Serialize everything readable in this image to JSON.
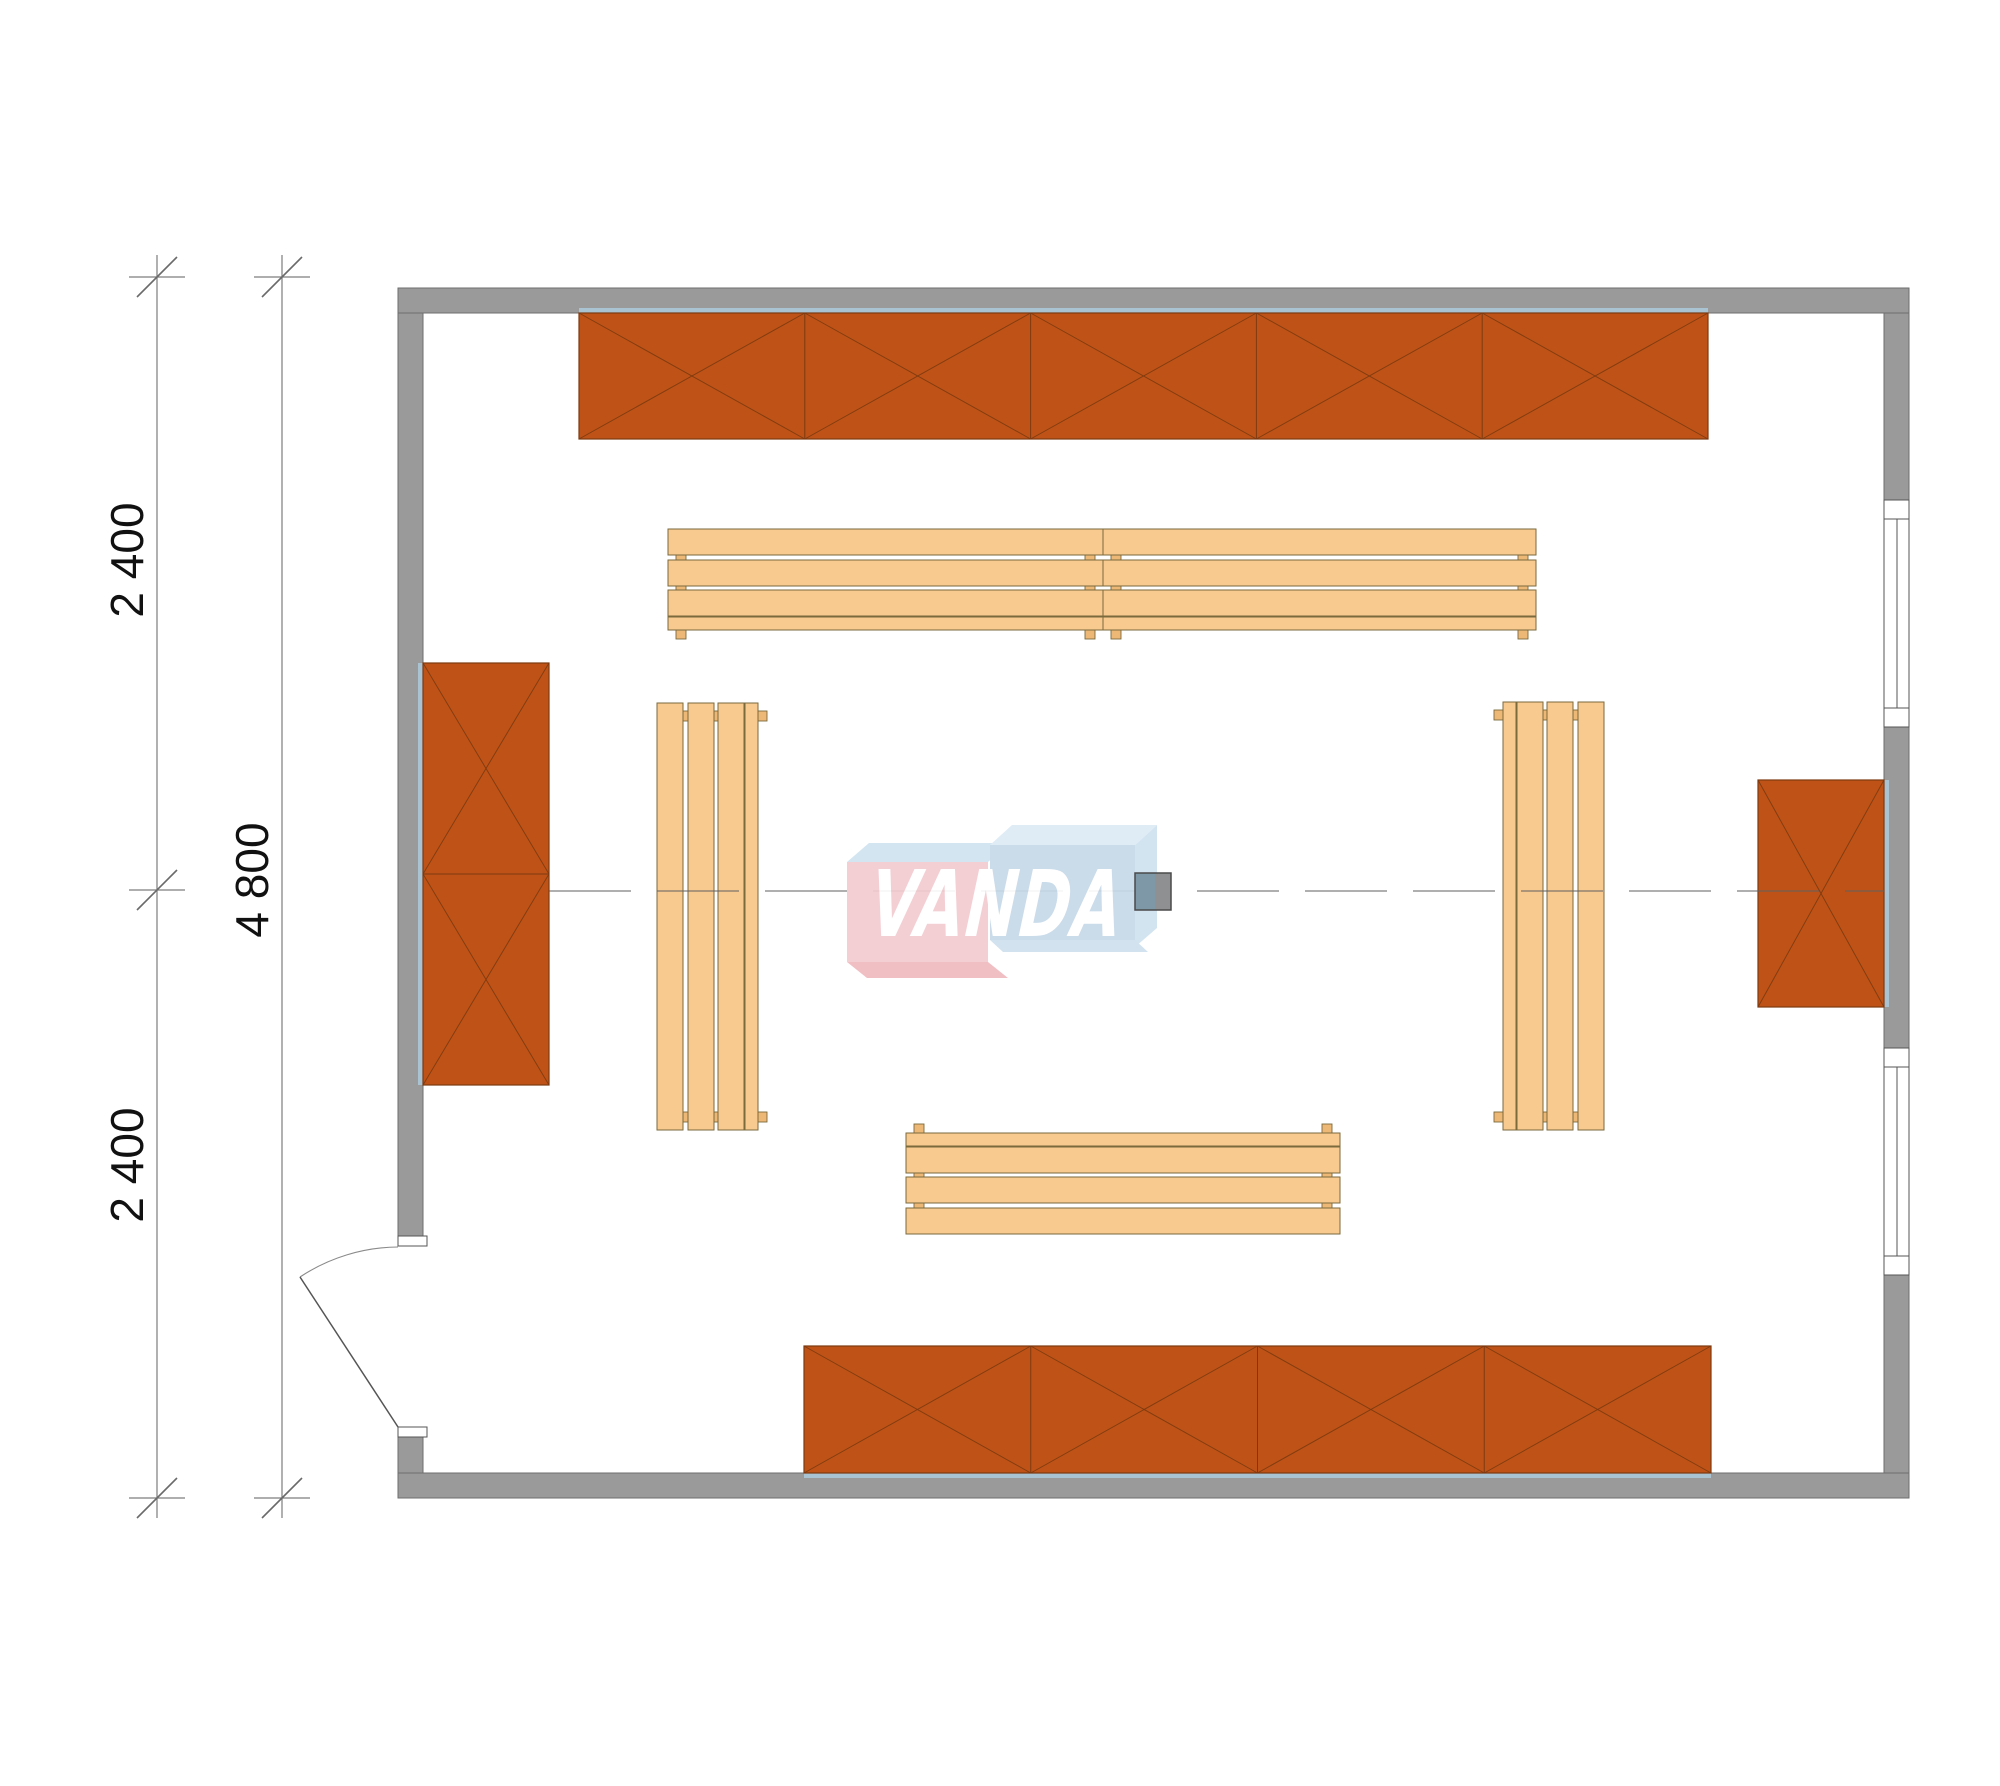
{
  "drawing": {
    "type": "floor-plan",
    "scale_note": "plan of room with wall cabinets and benches"
  },
  "dims": {
    "seg_top": "2 400",
    "seg_bottom": "2 400",
    "total": "4 800"
  },
  "watermark": {
    "text": "VANDA",
    "pink_face": "#f3ccd1",
    "pink_shadow": "#eebabf",
    "blue_face": "#c6d9e9",
    "blue_light": "#ddebf6",
    "blue_mid": "#d0e2f0",
    "text_color": "#ffffff"
  },
  "colors": {
    "wall": "#9a9a9a",
    "wall_edge": "#6e6e6e",
    "cabinet": "#bf5317",
    "cabinet_edge": "#7d3a10",
    "wood": "#f8ca90",
    "wood_edge": "#7a6a3c",
    "tint": "#a9c3d3",
    "line": "#5f5f5f",
    "stove_left": "#7f98a7",
    "stove_right": "#8f9091",
    "stove_edge": "#4a4a4a"
  },
  "cabinets": [
    {
      "name": "cabinet-row-top-wall",
      "x": 579,
      "y": 313,
      "w": 1129,
      "h": 126,
      "sections": 5,
      "dir": "h",
      "tint": "top"
    },
    {
      "name": "cabinet-row-bottom-wall",
      "x": 804,
      "y": 1346,
      "w": 907,
      "h": 127,
      "sections": 4,
      "dir": "h",
      "tint": "bottom"
    },
    {
      "name": "cabinet-left-wall",
      "x": 423,
      "y": 663,
      "w": 126,
      "h": 422,
      "sections": 2,
      "dir": "v",
      "tint": "left"
    },
    {
      "name": "cabinet-right-wall",
      "x": 1758,
      "y": 780,
      "w": 126,
      "h": 227,
      "sections": 1,
      "dir": "v",
      "tint": "right"
    }
  ],
  "benches": [
    {
      "name": "bench-top-left",
      "x": 668,
      "y": 529,
      "len": 435,
      "orient": "h",
      "flip": false
    },
    {
      "name": "bench-top-right",
      "x": 1103,
      "y": 529,
      "len": 433,
      "orient": "h",
      "flip": false
    },
    {
      "name": "bench-bottom",
      "x": 906,
      "y": 1125,
      "len": 434,
      "orient": "h",
      "flip": true
    },
    {
      "name": "bench-left",
      "x": 657,
      "y": 703,
      "len": 427,
      "orient": "v",
      "flip": false
    },
    {
      "name": "bench-right",
      "x": 1495,
      "y": 702,
      "len": 428,
      "orient": "v",
      "flip": true
    }
  ]
}
